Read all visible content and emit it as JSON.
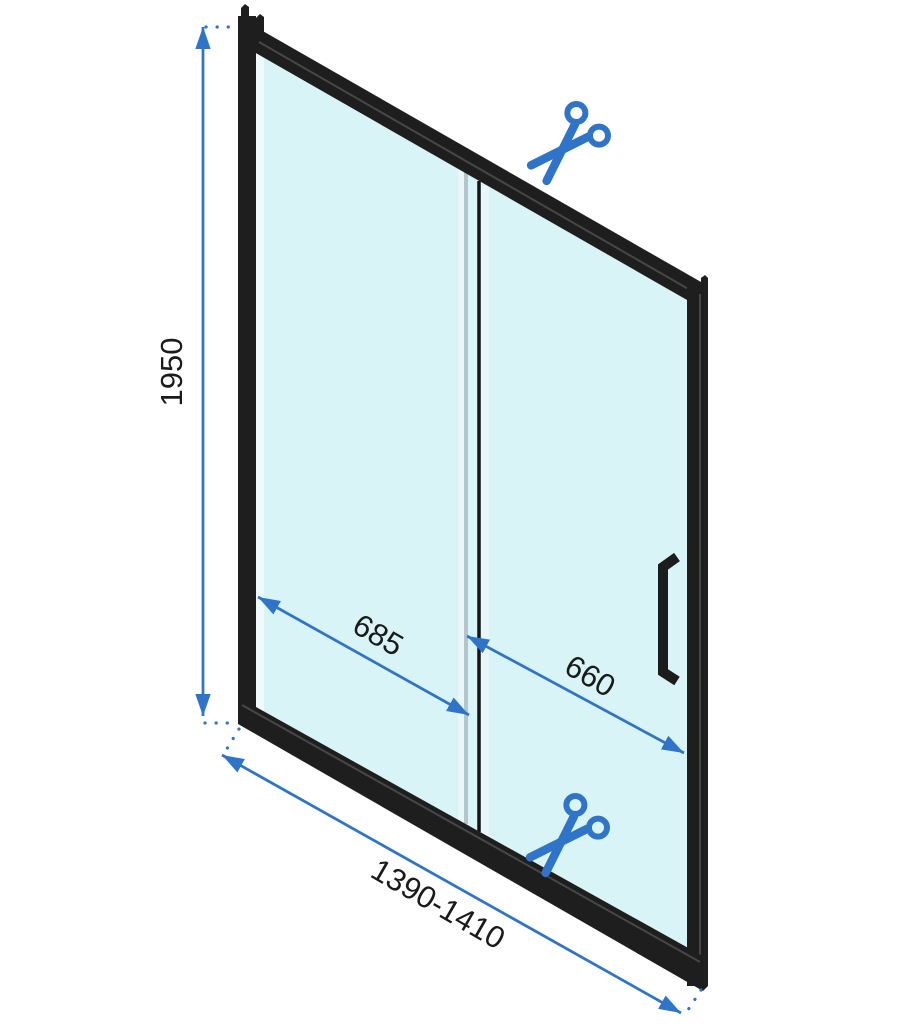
{
  "diagram": {
    "title": "shower-sliding-door-dimension-diagram",
    "dimensions": {
      "height": {
        "label": "1950"
      },
      "fixed_panel_width": {
        "label": "685"
      },
      "door_panel_width": {
        "label": "660"
      },
      "overall_width_range": {
        "label": "1390-1410"
      }
    },
    "icons": {
      "top_cut": "scissors-icon",
      "bottom_cut": "scissors-icon"
    },
    "colors": {
      "accent_blue": "#2F74C8",
      "glass": "#D9F4F7",
      "frame_black": "#1E1E1E",
      "glass_edge_grey": "#B3C6C9",
      "label_text": "#1A1A1A",
      "background": "#FFFFFF"
    }
  }
}
